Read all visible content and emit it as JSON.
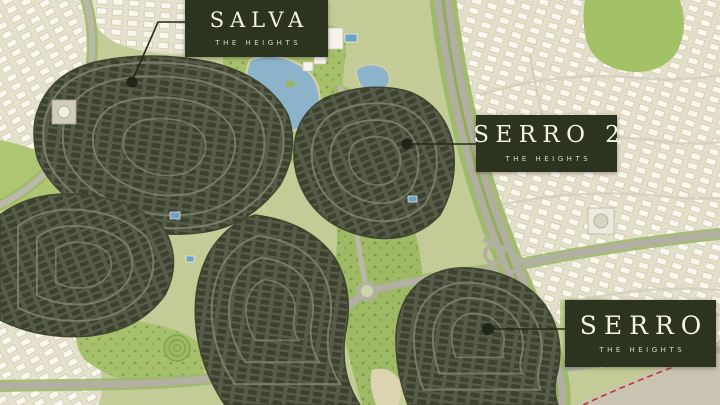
{
  "map": {
    "title": "The Heights master plan map",
    "labels": [
      {
        "id": "salva",
        "name": "SALVA",
        "subtitle": "THE HEIGHTS"
      },
      {
        "id": "serro2",
        "name": "SERRO 2",
        "subtitle": "THE HEIGHTS"
      },
      {
        "id": "serro",
        "name": "SERRO",
        "subtitle": "THE HEIGHTS"
      }
    ],
    "colors": {
      "label_background": "#2c331f",
      "label_text": "#f7f4e4",
      "label_subtitle_text": "#ddd9c2",
      "leader_line": "#232a18",
      "marker_dot": "#1f2617",
      "dark_cluster": "#4c5140",
      "dark_cluster_houses": "#3c4130",
      "parkland_green": "#a6c06b",
      "ground_green": "#c3cb97",
      "community_beige": "#e4dfc9",
      "house_white": "#fbfaf2",
      "water_blue": "#8db3cb",
      "road_grey": "#b3b0a3",
      "sand_grey": "#c9c3b2",
      "boundary_red_dashed": "#c0392b"
    }
  }
}
